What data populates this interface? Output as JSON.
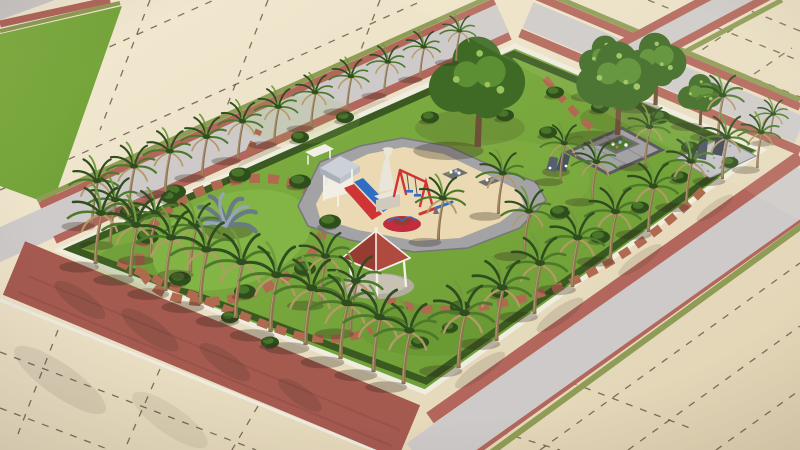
{
  "meta": {
    "description": "Isometric 3D architectural rendering of a rectangular neighborhood park surrounded by grey roads with brick-red sidewalks and beige land parcels marked by dashed plot lines. The park has a white curb and dark hedge, rows of palm trees, a circular lawn with a grey agave sculpture ringed by stepping stones, a central sand playground with red and blue slides, swing set, seesaw and red carousel, a white child statue, a red-roofed gazebo, a grey paved seating square with a flower planter under large leafy trees, a gravel corner with standing stones, and curved brick paver paths."
  },
  "colors": {
    "beige": "#ecdfc4",
    "beige_dark": "#e0d2b2",
    "parcel_line": "#5a4a3a",
    "road": "#cecac9",
    "road_dark": "#bdb7b6",
    "red_walk": "#b2665c",
    "red_band": "#a55a50",
    "olive": "#8f9c55",
    "lawn": "#76a53c",
    "lawn_light": "#8fbe52",
    "lawn_dark": "#567f2a",
    "hedge": "#3a5a22",
    "curb": "#efece0",
    "paver": "#b06a4f",
    "sand": "#ead9b2",
    "pave_grey": "#a3a3a6",
    "pave_dark": "#6f6f73",
    "gravel": "#c3c3c7",
    "frond": "#2f4d1f",
    "frond_light": "#4d7a2a",
    "frond_pale": "#6f9c3e",
    "dried": "#b49a66",
    "trunk": "#8d7250",
    "trunk_light": "#b29a72",
    "leafy": "#3e6a25",
    "leafy_light": "#5c8f33",
    "leafy_pale": "#9cc25e",
    "bush": "#2e4e1c",
    "bush_light": "#49752a",
    "red_play": "#cf3535",
    "blue_play": "#2f6fc2",
    "carousel": "#c22c3c",
    "roof_red": "#b04a3e",
    "roof_red_dark": "#963c32",
    "white": "#f2efe8",
    "statue": "#e9e5d8",
    "stone": "#55606c",
    "agave": "#6a7a85",
    "agave_light": "#95a7b2",
    "shadow": "rgba(50,40,28,0.30)"
  },
  "objects": {
    "palms": [
      [
        92,
        224,
        0.85
      ],
      [
        129,
        208,
        0.82
      ],
      [
        165,
        192,
        0.8
      ],
      [
        202,
        176,
        0.77
      ],
      [
        238,
        159,
        0.74
      ],
      [
        274,
        143,
        0.71
      ],
      [
        311,
        127,
        0.68
      ],
      [
        347,
        110,
        0.66
      ],
      [
        384,
        94,
        0.63
      ],
      [
        420,
        78,
        0.61
      ],
      [
        456,
        61,
        0.59
      ],
      [
        95,
        264,
        1.0
      ],
      [
        130,
        277,
        1.02
      ],
      [
        165,
        291,
        1.05
      ],
      [
        200,
        304,
        1.07
      ],
      [
        235,
        318,
        1.1
      ],
      [
        270,
        332,
        1.12
      ],
      [
        305,
        345,
        1.12
      ],
      [
        340,
        359,
        1.1
      ],
      [
        373,
        372,
        1.08
      ],
      [
        403,
        384,
        1.05
      ],
      [
        110,
        243,
        0.85
      ],
      [
        150,
        258,
        0.88
      ],
      [
        190,
        272,
        0.9
      ],
      [
        458,
        368,
        1.08
      ],
      [
        496,
        341,
        1.05
      ],
      [
        534,
        314,
        1.0
      ],
      [
        572,
        287,
        0.97
      ],
      [
        610,
        259,
        0.93
      ],
      [
        648,
        232,
        0.9
      ],
      [
        686,
        205,
        0.86
      ],
      [
        722,
        179,
        0.82
      ],
      [
        438,
        240,
        0.82
      ],
      [
        498,
        214,
        0.8
      ],
      [
        524,
        254,
        0.84
      ],
      [
        560,
        180,
        0.72
      ],
      [
        592,
        200,
        0.75
      ],
      [
        645,
        165,
        0.75
      ],
      [
        718,
        135,
        0.78
      ],
      [
        757,
        168,
        0.7
      ],
      [
        770,
        142,
        0.55
      ],
      [
        320,
        303,
        0.92
      ],
      [
        350,
        331,
        0.98
      ]
    ],
    "leafy_trees": [
      [
        477,
        147,
        1.3
      ],
      [
        617,
        135,
        1.1
      ],
      [
        655,
        105,
        0.85
      ],
      [
        605,
        95,
        0.7
      ],
      [
        700,
        125,
        0.6
      ]
    ],
    "bushes": [
      [
        330,
        225,
        1.1
      ],
      [
        300,
        185,
        1.1
      ],
      [
        240,
        178,
        1.1
      ],
      [
        175,
        195,
        1.1
      ],
      [
        148,
        240,
        1.1
      ],
      [
        180,
        282,
        1.1
      ],
      [
        245,
        295,
        1.1
      ],
      [
        305,
        272,
        1.1
      ],
      [
        130,
        215,
        1.0
      ],
      [
        170,
        200,
        0.9
      ],
      [
        300,
        140,
        0.9
      ],
      [
        345,
        120,
        0.9
      ],
      [
        430,
        120,
        0.9
      ],
      [
        505,
        118,
        0.9
      ],
      [
        548,
        135,
        0.9
      ],
      [
        555,
        95,
        0.9
      ],
      [
        600,
        110,
        0.9
      ],
      [
        660,
        120,
        1.0
      ],
      [
        690,
        150,
        0.9
      ],
      [
        730,
        165,
        0.85
      ],
      [
        560,
        215,
        1.0
      ],
      [
        600,
        240,
        1.0
      ],
      [
        640,
        210,
        0.9
      ],
      [
        680,
        180,
        0.9
      ],
      [
        460,
        310,
        1.0
      ],
      [
        500,
        295,
        0.9
      ],
      [
        230,
        320,
        0.9
      ],
      [
        270,
        345,
        0.9
      ],
      [
        420,
        345,
        0.9
      ],
      [
        450,
        330,
        0.8
      ]
    ]
  },
  "features": [
    "land-parcels",
    "perimeter-roads",
    "park-lawn",
    "circular-lawn",
    "agave-sculpture",
    "stepping-stone-ring",
    "playground",
    "play-tower",
    "red-slide",
    "blue-slide",
    "swing-set",
    "seesaw",
    "carousel",
    "child-statue",
    "gazebo",
    "paved-square",
    "flower-planter",
    "gravel-corner",
    "standing-stones",
    "paver-paths",
    "palm-rows",
    "hedge"
  ]
}
